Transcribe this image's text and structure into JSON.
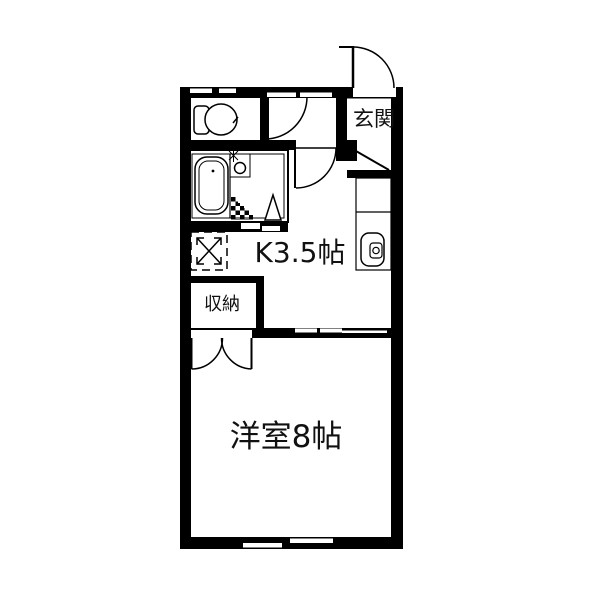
{
  "colors": {
    "background": "#ffffff",
    "line": "#000000",
    "text": "#111111"
  },
  "floorplan": {
    "rooms": {
      "entrance": {
        "label": "玄関"
      },
      "kitchen": {
        "label": "K3.5帖"
      },
      "storage": {
        "label": "収納"
      },
      "western_room": {
        "label": "洋室8帖"
      }
    },
    "icons": [
      "toilet-icon",
      "bathtub-icon",
      "shower-faucet-icon",
      "drain-grid-icon",
      "bath-door-triangle-icon",
      "kitchen-sink-icon",
      "washer-space-icon",
      "entrance-door-icon",
      "hinged-door-icon",
      "closet-double-door-icon",
      "sliding-window-icon",
      "entrance-step-line"
    ]
  }
}
